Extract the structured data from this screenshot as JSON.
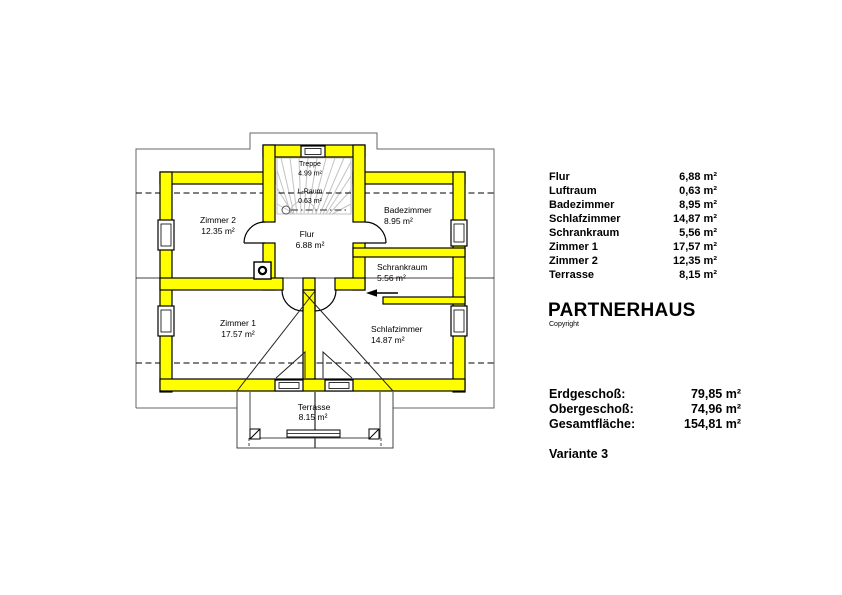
{
  "plan": {
    "labels": {
      "treppe": {
        "name": "Treppe",
        "area": "4.99 m²"
      },
      "lraum": {
        "name": "L-Raum",
        "area": "0.63 m²"
      },
      "zimmer2": {
        "name": "Zimmer 2",
        "area": "12.35 m²"
      },
      "flur": {
        "name": "Flur",
        "area": "6.88 m²"
      },
      "badezimmer": {
        "name": "Badezimmer",
        "area": "8.95 m²"
      },
      "schrankraum": {
        "name": "Schrankraum",
        "area": "5.56 m²"
      },
      "zimmer1": {
        "name": "Zimmer 1",
        "area": "17.57 m²"
      },
      "schlafzimmer": {
        "name": "Schlafzimmer",
        "area": "14.87 m²"
      },
      "terrasse": {
        "name": "Terrasse",
        "area": "8.15 m²"
      }
    },
    "colors": {
      "wall_fill": "#ffff00",
      "outline": "#000000",
      "stair_lines": "#c3c3c3",
      "roof_outline": "#666666"
    }
  },
  "legend": {
    "rows": [
      {
        "label": "Flur",
        "value": "6,88 m²"
      },
      {
        "label": "Luftraum",
        "value": "0,63 m²"
      },
      {
        "label": "Badezimmer",
        "value": "8,95 m²"
      },
      {
        "label": "Schlafzimmer",
        "value": "14,87 m²"
      },
      {
        "label": "Schrankraum",
        "value": "5,56 m²"
      },
      {
        "label": "Zimmer 1",
        "value": "17,57 m²"
      },
      {
        "label": "Zimmer 2",
        "value": "12,35 m²"
      },
      {
        "label": "Terrasse",
        "value": "8,15 m²"
      }
    ],
    "title": "PARTNERHAUS",
    "copyright": "Copyright",
    "totals": [
      {
        "label": "Erdgeschoß:",
        "value": "79,85 m²"
      },
      {
        "label": "Obergeschoß:",
        "value": "74,96 m²"
      },
      {
        "label": "Gesamtfläche:",
        "value": "154,81 m²"
      }
    ],
    "variant": "Variante 3"
  }
}
